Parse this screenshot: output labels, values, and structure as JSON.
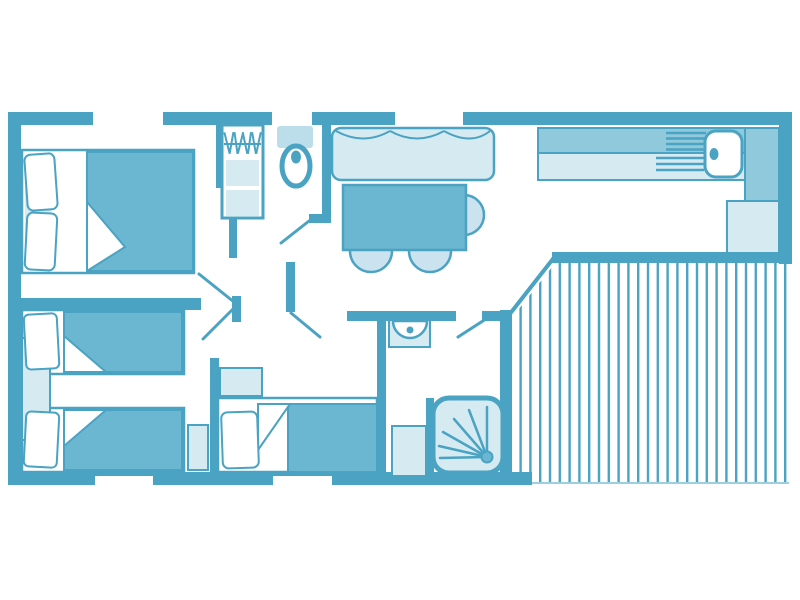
{
  "plan": {
    "palette": {
      "wall": "#4AA3C2",
      "furniture_mid": "#6BB6D0",
      "counter_mid": "#8FC9DB",
      "light": "#D6EAF2",
      "chair_light": "#CBE3EF",
      "cistern": "#BCDDEA",
      "deck_stripe": "#4AA3C2",
      "deck_edge": "#9CCFDF",
      "white": "#FFFFFF"
    },
    "legend": {
      "rooms": [
        "master-bedroom",
        "twin-bedroom",
        "third-bedroom",
        "wc",
        "shower-room",
        "hallway",
        "living-dining-area",
        "kitchen",
        "terrace-deck"
      ],
      "furniture_icons": [
        "double-bed-icon",
        "single-bed-icon",
        "single-bed-icon",
        "single-bed-icon",
        "wardrobe-hangers-icon",
        "toilet-icon",
        "sofa-icon",
        "dining-table-icon",
        "dining-chair-icon",
        "kitchen-counter-icon",
        "kitchen-sink-icon",
        "washbasin-icon",
        "shower-icon",
        "nightstand-icon",
        "shelf-icon",
        "storage-cabinet-icon",
        "deck-boards-icon"
      ]
    }
  }
}
